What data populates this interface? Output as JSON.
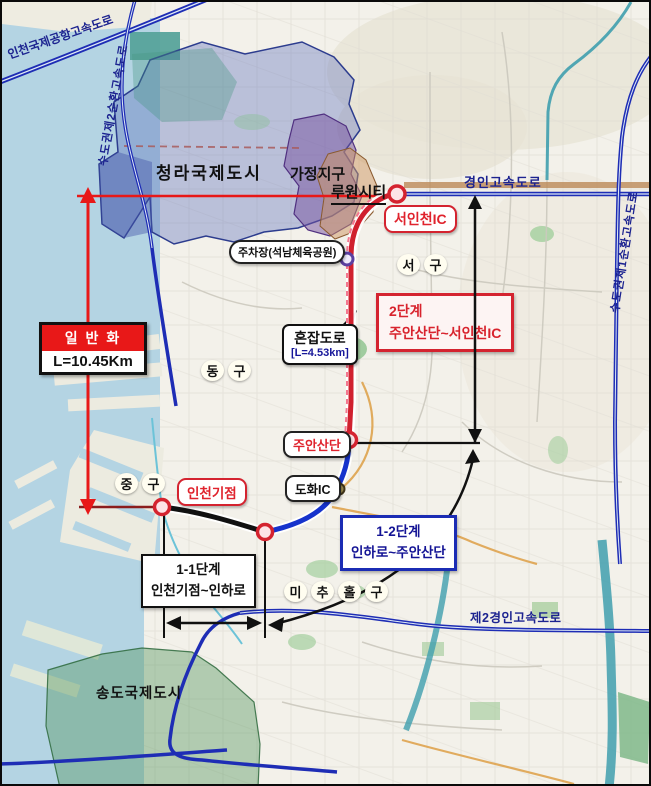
{
  "map": {
    "regions": {
      "cheongna": "청라국제도시",
      "gajeong": "가정지구",
      "luone": "루원시티",
      "songdo": "송도국제도시"
    },
    "districts": {
      "seo": "서구",
      "dong": "동구",
      "jung": "중구",
      "michuhol": "미추홀구"
    },
    "expressways": {
      "incheon_airport": "인천국제공항고속도로",
      "ring2": "수도권제2순환고속도로",
      "gyeongin": "경인고속도로",
      "ring1": "수도권제1순환고속도로",
      "gyeongin2": "제2경인고속도로"
    },
    "points": {
      "seoincheon_ic": "서인천IC",
      "parking": "주차장(석남체육공원)",
      "juan": "주안산단",
      "dohwa_ic": "도화IC",
      "incheon_start": "인천기점"
    },
    "callouts": {
      "generalization": {
        "title": "일 반 화",
        "length": "L=10.45Km"
      },
      "congested": {
        "title": "혼잡도로",
        "length": "[L=4.53km]"
      },
      "phase2": {
        "line1": "2단계",
        "line2": "주안산단~서인천IC"
      },
      "phase1_2": {
        "line1": "1-2단계",
        "line2": "인하로~주안산단"
      },
      "phase1_1": {
        "line1": "1-1단계",
        "line2": "인천기점~인하로"
      }
    },
    "colors": {
      "expressway_blue": "#1e2db5",
      "route_red": "#d0202e",
      "route_blue": "#1633cc",
      "route_black": "#111111",
      "measure_red": "#e81818",
      "water": "#b4d4e3"
    }
  }
}
